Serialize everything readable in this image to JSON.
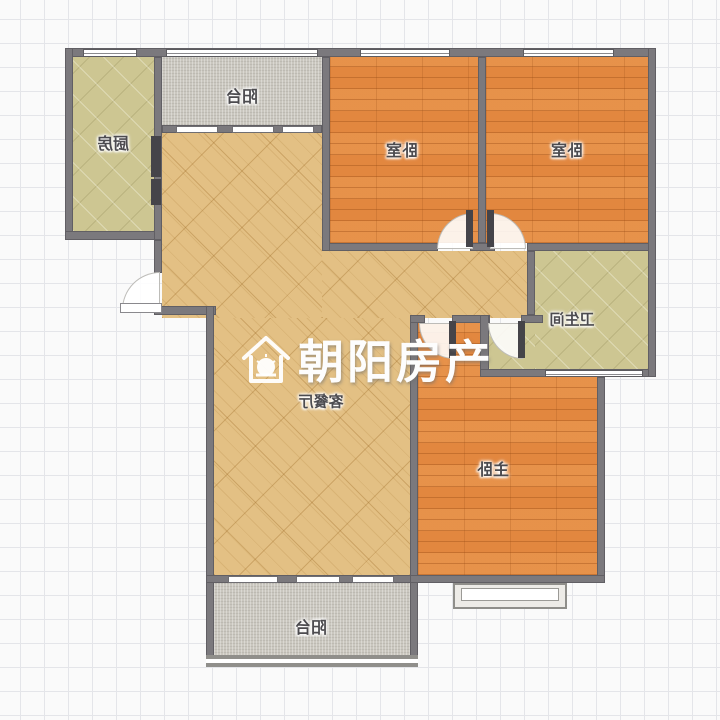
{
  "plan": {
    "kind": "apartment-floor-plan",
    "base_image_mirrored": true,
    "watermark": {
      "brand": "朝阳房产",
      "icon": "house-sun-icon"
    },
    "rooms": [
      {
        "id": "kitchen",
        "label": "厨房",
        "floor": "olive-tile"
      },
      {
        "id": "balcony-top",
        "label": "阳台",
        "floor": "gray-stone"
      },
      {
        "id": "bedroom-left",
        "label": "卧室",
        "floor": "orange-wood"
      },
      {
        "id": "bedroom-right",
        "label": "卧室",
        "floor": "orange-wood"
      },
      {
        "id": "bathroom",
        "label": "卫生间",
        "floor": "olive-tile"
      },
      {
        "id": "living-dining",
        "label": "客餐厅",
        "floor": "tan-tile"
      },
      {
        "id": "master-bedroom",
        "label": "主卧",
        "floor": "orange-wood"
      },
      {
        "id": "balcony-bottom",
        "label": "阳台",
        "floor": "gray-stone"
      }
    ],
    "colors": {
      "wall": "#7b797d",
      "wood_floor": "#e2873f",
      "tan_tile": "#e3c084",
      "olive_tile": "#cdc692",
      "balcony_floor": "#cac7bf",
      "grid_line": "#e4e5e9",
      "watermark_text": "#fdfdfd"
    }
  }
}
